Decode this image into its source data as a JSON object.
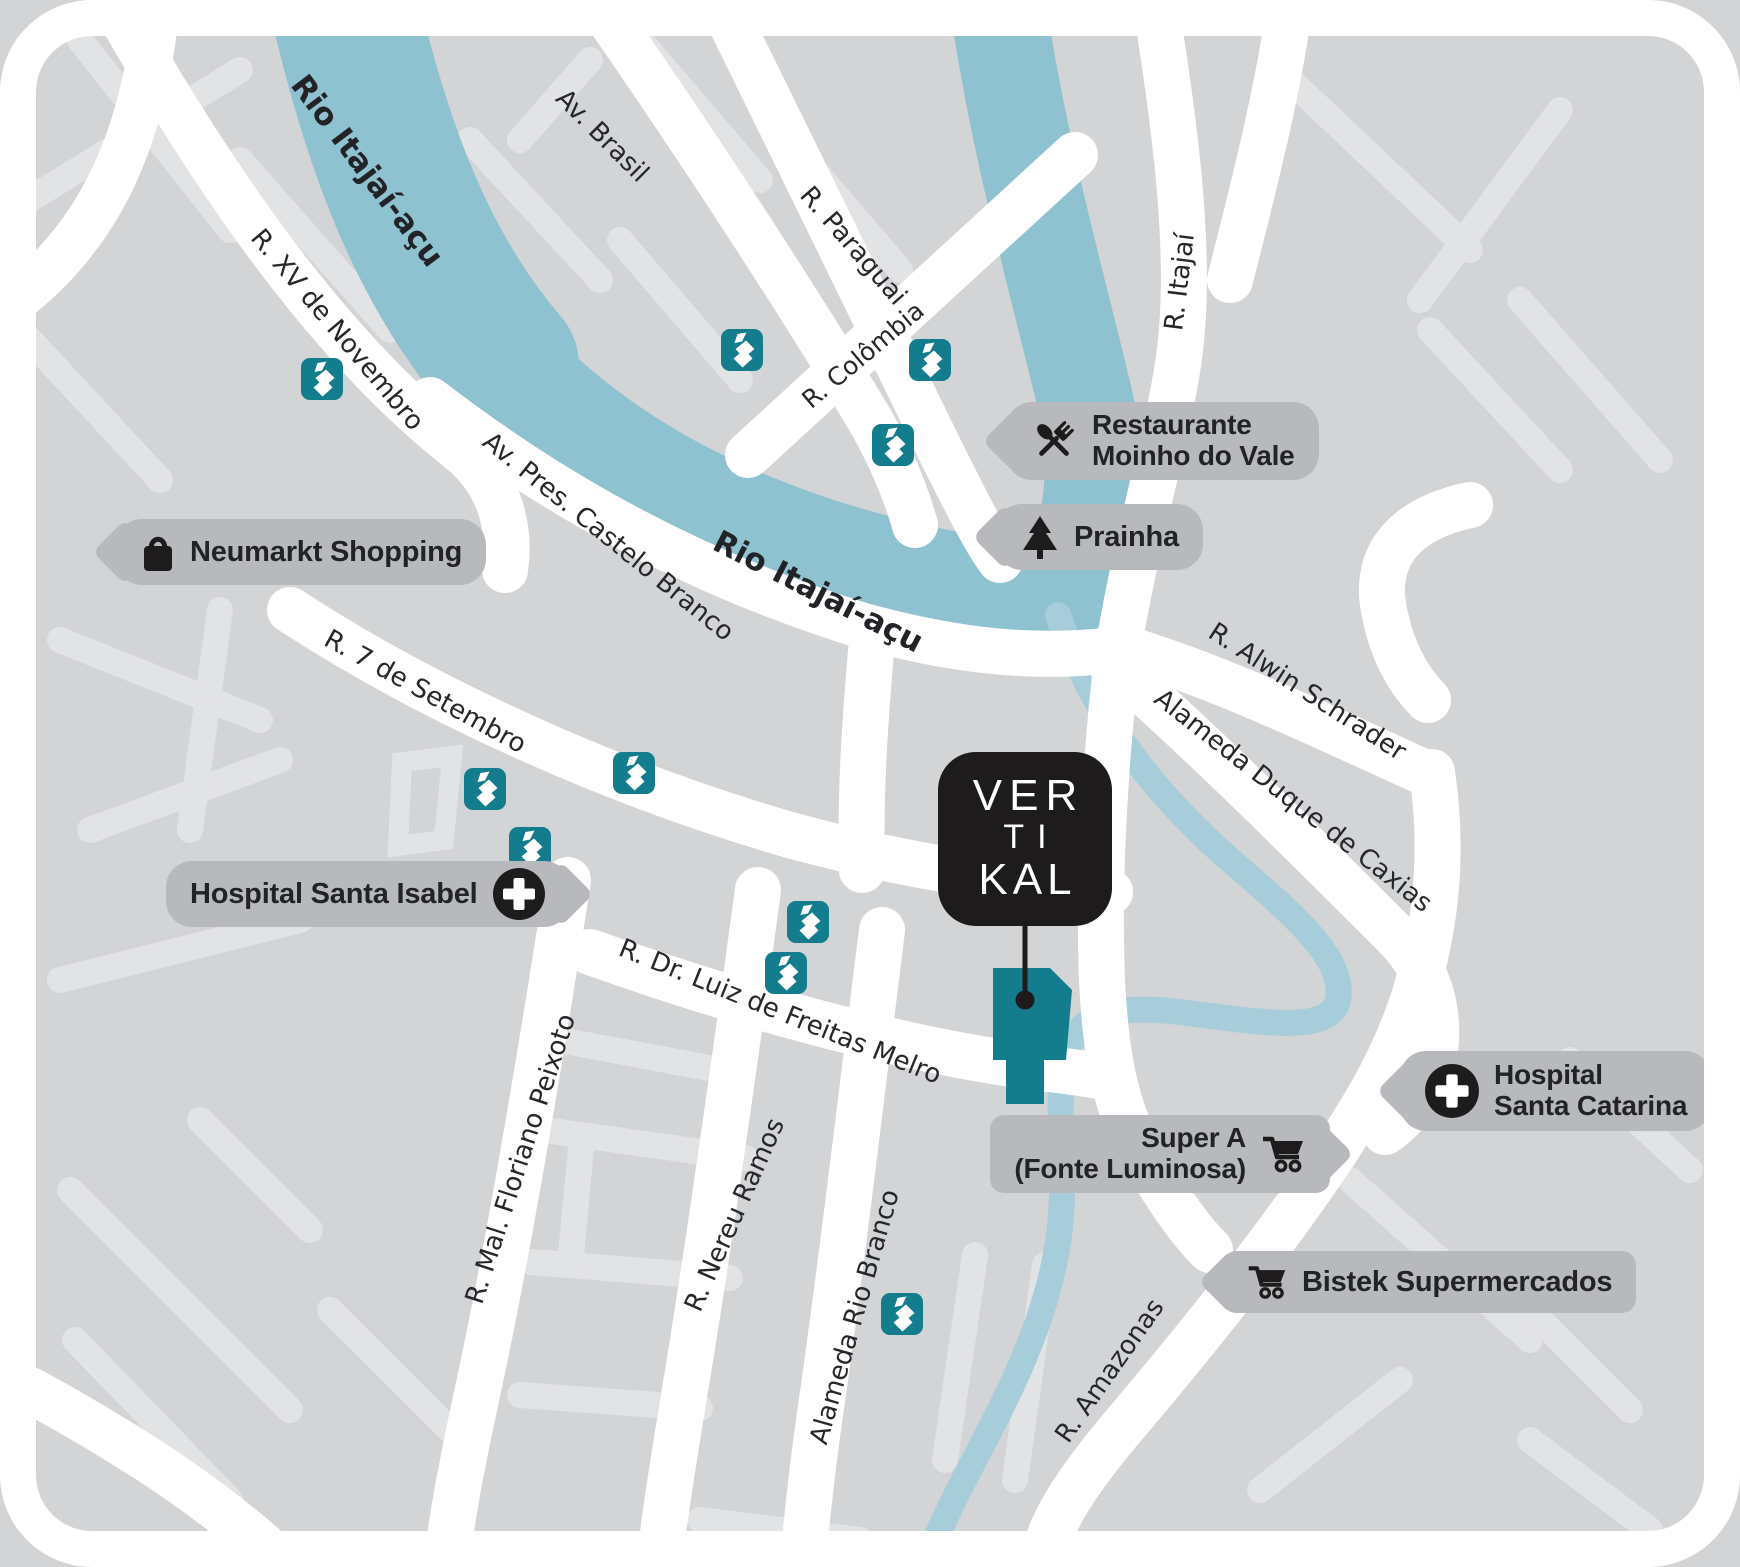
{
  "map_title": "VERTIKAL location map",
  "colors": {
    "map_bg": "#d2d4d6",
    "road_primary": "#ffffff",
    "road_minor": "#e2e3e5",
    "river": "#8fc2d0",
    "stream": "#a6cdd9",
    "brand_teal": "#137d8d",
    "ink": "#1d1b1c",
    "bubble_bg": "#b7b9bc",
    "bubble_text": "#222326"
  },
  "logo": {
    "lines": [
      "VER",
      "TI",
      "KAL"
    ]
  },
  "pois": {
    "neumarkt": {
      "label": "Neumarkt Shopping",
      "icon": "shopping-bag"
    },
    "restaurante": {
      "line1": "Restaurante",
      "line2": "Moinho do Vale",
      "icon": "restaurant"
    },
    "prainha": {
      "label": "Prainha",
      "icon": "pine-tree"
    },
    "isabel": {
      "label": "Hospital Santa Isabel",
      "icon": "medical-cross"
    },
    "supera": {
      "line1": "Super A",
      "line2": "(Fonte Luminosa)",
      "icon": "shopping-cart"
    },
    "catarina": {
      "line1": "Hospital",
      "line2": "Santa Catarina",
      "icon": "medical-cross"
    },
    "bistek": {
      "label": "Bistek Supermercados",
      "icon": "shopping-cart"
    }
  },
  "streets": [
    {
      "slug": "rio-itajai-acu-upper",
      "label": "Rio Itajaí-açu",
      "x": 367,
      "y": 171,
      "rot": 53,
      "size": 31,
      "river": true
    },
    {
      "slug": "av-brasil",
      "label": "Av. Brasil",
      "x": 602,
      "y": 136,
      "rot": 45,
      "size": 26
    },
    {
      "slug": "r-paraguai",
      "label": "R. Paraguai",
      "x": 853,
      "y": 246,
      "rot": 49,
      "size": 26
    },
    {
      "slug": "r-colombia",
      "label": "R. Colômbia",
      "x": 863,
      "y": 355,
      "rot": -40,
      "size": 25
    },
    {
      "slug": "r-itajai",
      "label": "R. Itajaí",
      "x": 1180,
      "y": 282,
      "rot": -83,
      "size": 26
    },
    {
      "slug": "r-xv-de-novembro",
      "label": "R. XV de Novembro",
      "x": 337,
      "y": 330,
      "rot": 50,
      "size": 26
    },
    {
      "slug": "av-pres-castelo-branco",
      "label": "Av. Pres. Castelo Branco",
      "x": 608,
      "y": 537,
      "rot": 39,
      "size": 26
    },
    {
      "slug": "rio-itajai-acu-lower",
      "label": "Rio Itajaí-açu",
      "x": 818,
      "y": 592,
      "rot": 27,
      "size": 31,
      "river": true
    },
    {
      "slug": "r-alwin-schrader",
      "label": "R. Alwin Schrader",
      "x": 1307,
      "y": 692,
      "rot": 33,
      "size": 26
    },
    {
      "slug": "alameda-duque-de-caxias",
      "label": "Alameda Duque de Caxias",
      "x": 1293,
      "y": 801,
      "rot": 38,
      "size": 26
    },
    {
      "slug": "r-7-de-setembro",
      "label": "R. 7 de Setembro",
      "x": 425,
      "y": 692,
      "rot": 29,
      "size": 26
    },
    {
      "slug": "r-dr-luiz-de-freitas-melro",
      "label": "R. Dr. Luiz de Freitas Melro",
      "x": 780,
      "y": 1012,
      "rot": 22,
      "size": 26
    },
    {
      "slug": "r-mal-floriano-peixoto",
      "label": "R. Mal. Floriano Peixoto",
      "x": 521,
      "y": 1159,
      "rot": -72,
      "size": 26
    },
    {
      "slug": "r-nereu-ramos",
      "label": "R. Nereu Ramos",
      "x": 735,
      "y": 1215,
      "rot": -66,
      "size": 26
    },
    {
      "slug": "alameda-rio-branco",
      "label": "Alameda Rio Branco",
      "x": 855,
      "y": 1317,
      "rot": -74,
      "size": 26
    },
    {
      "slug": "r-amazonas",
      "label": "R. Amazonas",
      "x": 1110,
      "y": 1371,
      "rot": -55,
      "size": 26
    }
  ],
  "markers": [
    {
      "x": 322,
      "y": 379
    },
    {
      "x": 742,
      "y": 350
    },
    {
      "x": 930,
      "y": 360
    },
    {
      "x": 893,
      "y": 445
    },
    {
      "x": 485,
      "y": 789
    },
    {
      "x": 634,
      "y": 773
    },
    {
      "x": 530,
      "y": 848
    },
    {
      "x": 808,
      "y": 922
    },
    {
      "x": 786,
      "y": 973
    },
    {
      "x": 902,
      "y": 1314
    }
  ]
}
